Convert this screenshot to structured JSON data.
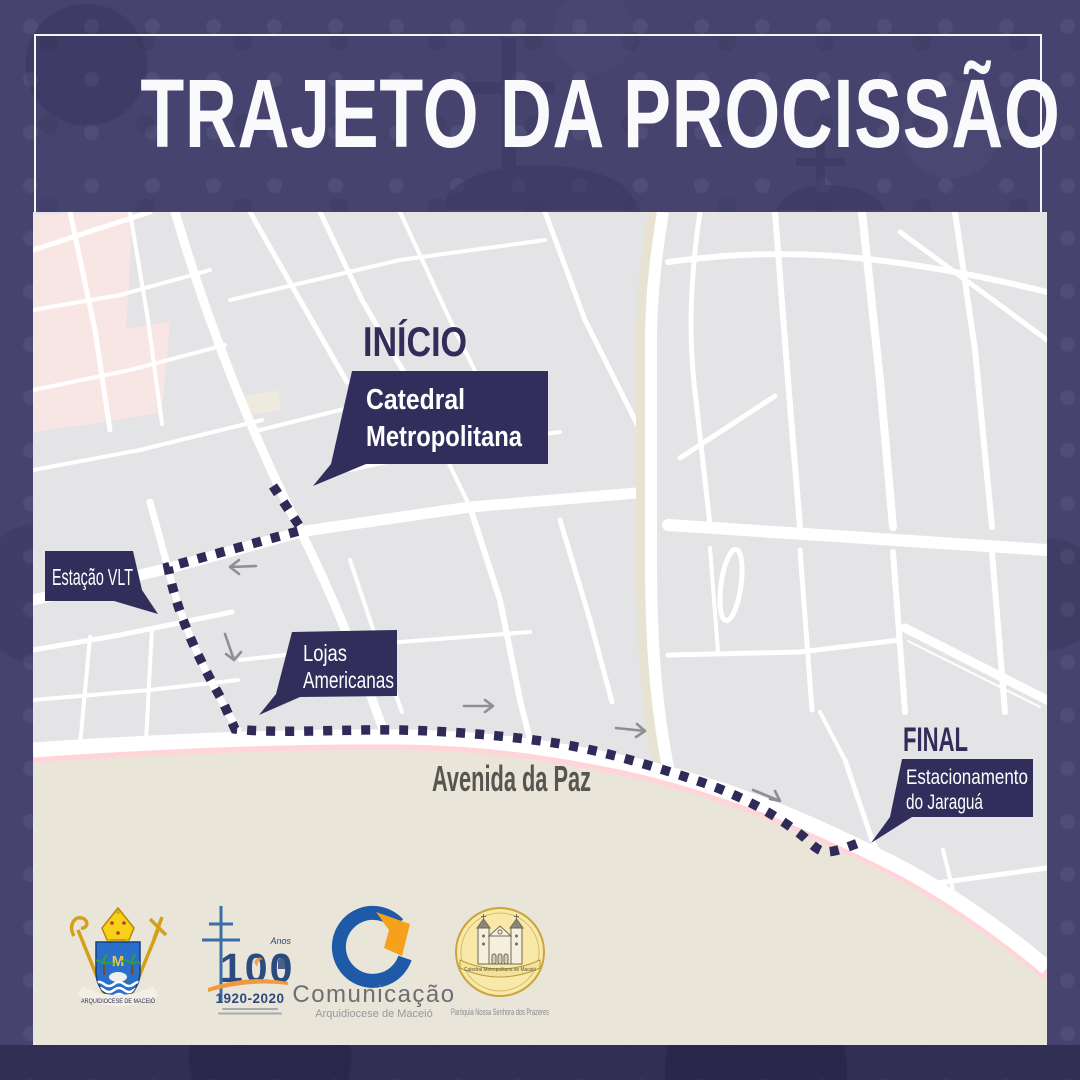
{
  "title": "TRAJETO DA PROCISSÃO",
  "map": {
    "start": {
      "label": "INÍCIO",
      "callout": [
        "Catedral",
        "Metropolitana"
      ]
    },
    "station": {
      "callout": "Estação VLT"
    },
    "store": {
      "callout": [
        "Lojas",
        "Americanas"
      ]
    },
    "avenue": {
      "label": "Avenida da Paz"
    },
    "end": {
      "label": "FINAL",
      "callout": [
        "Estacionamento",
        "do Jaraguá"
      ]
    }
  },
  "logos": {
    "arquidiocese": {
      "banner": "ARQUIDIOCESE DE MACEIÓ"
    },
    "centenario": {
      "number": "100",
      "anos": "Anos",
      "years": "1920-2020"
    },
    "comunicacao": {
      "title": "Comunicação",
      "subtitle": "Arquidiocese de Maceió"
    },
    "paroquia": {
      "ribbon": "Catedral Metropolitana de Maceió",
      "caption": "Paróquia Nossa Senhora dos Prazeres"
    }
  },
  "colors": {
    "border_purple": "#46446f",
    "accent_navy": "#312d58",
    "map_gray": "#e4e4e7",
    "street_white": "#ffffff",
    "district_pink": "#f8e6e4",
    "coast_pink": "#ffd5da",
    "sand": "#e9e5d9",
    "arrow_gray": "#8f8f92",
    "avenue_label_gray": "#57554f"
  }
}
